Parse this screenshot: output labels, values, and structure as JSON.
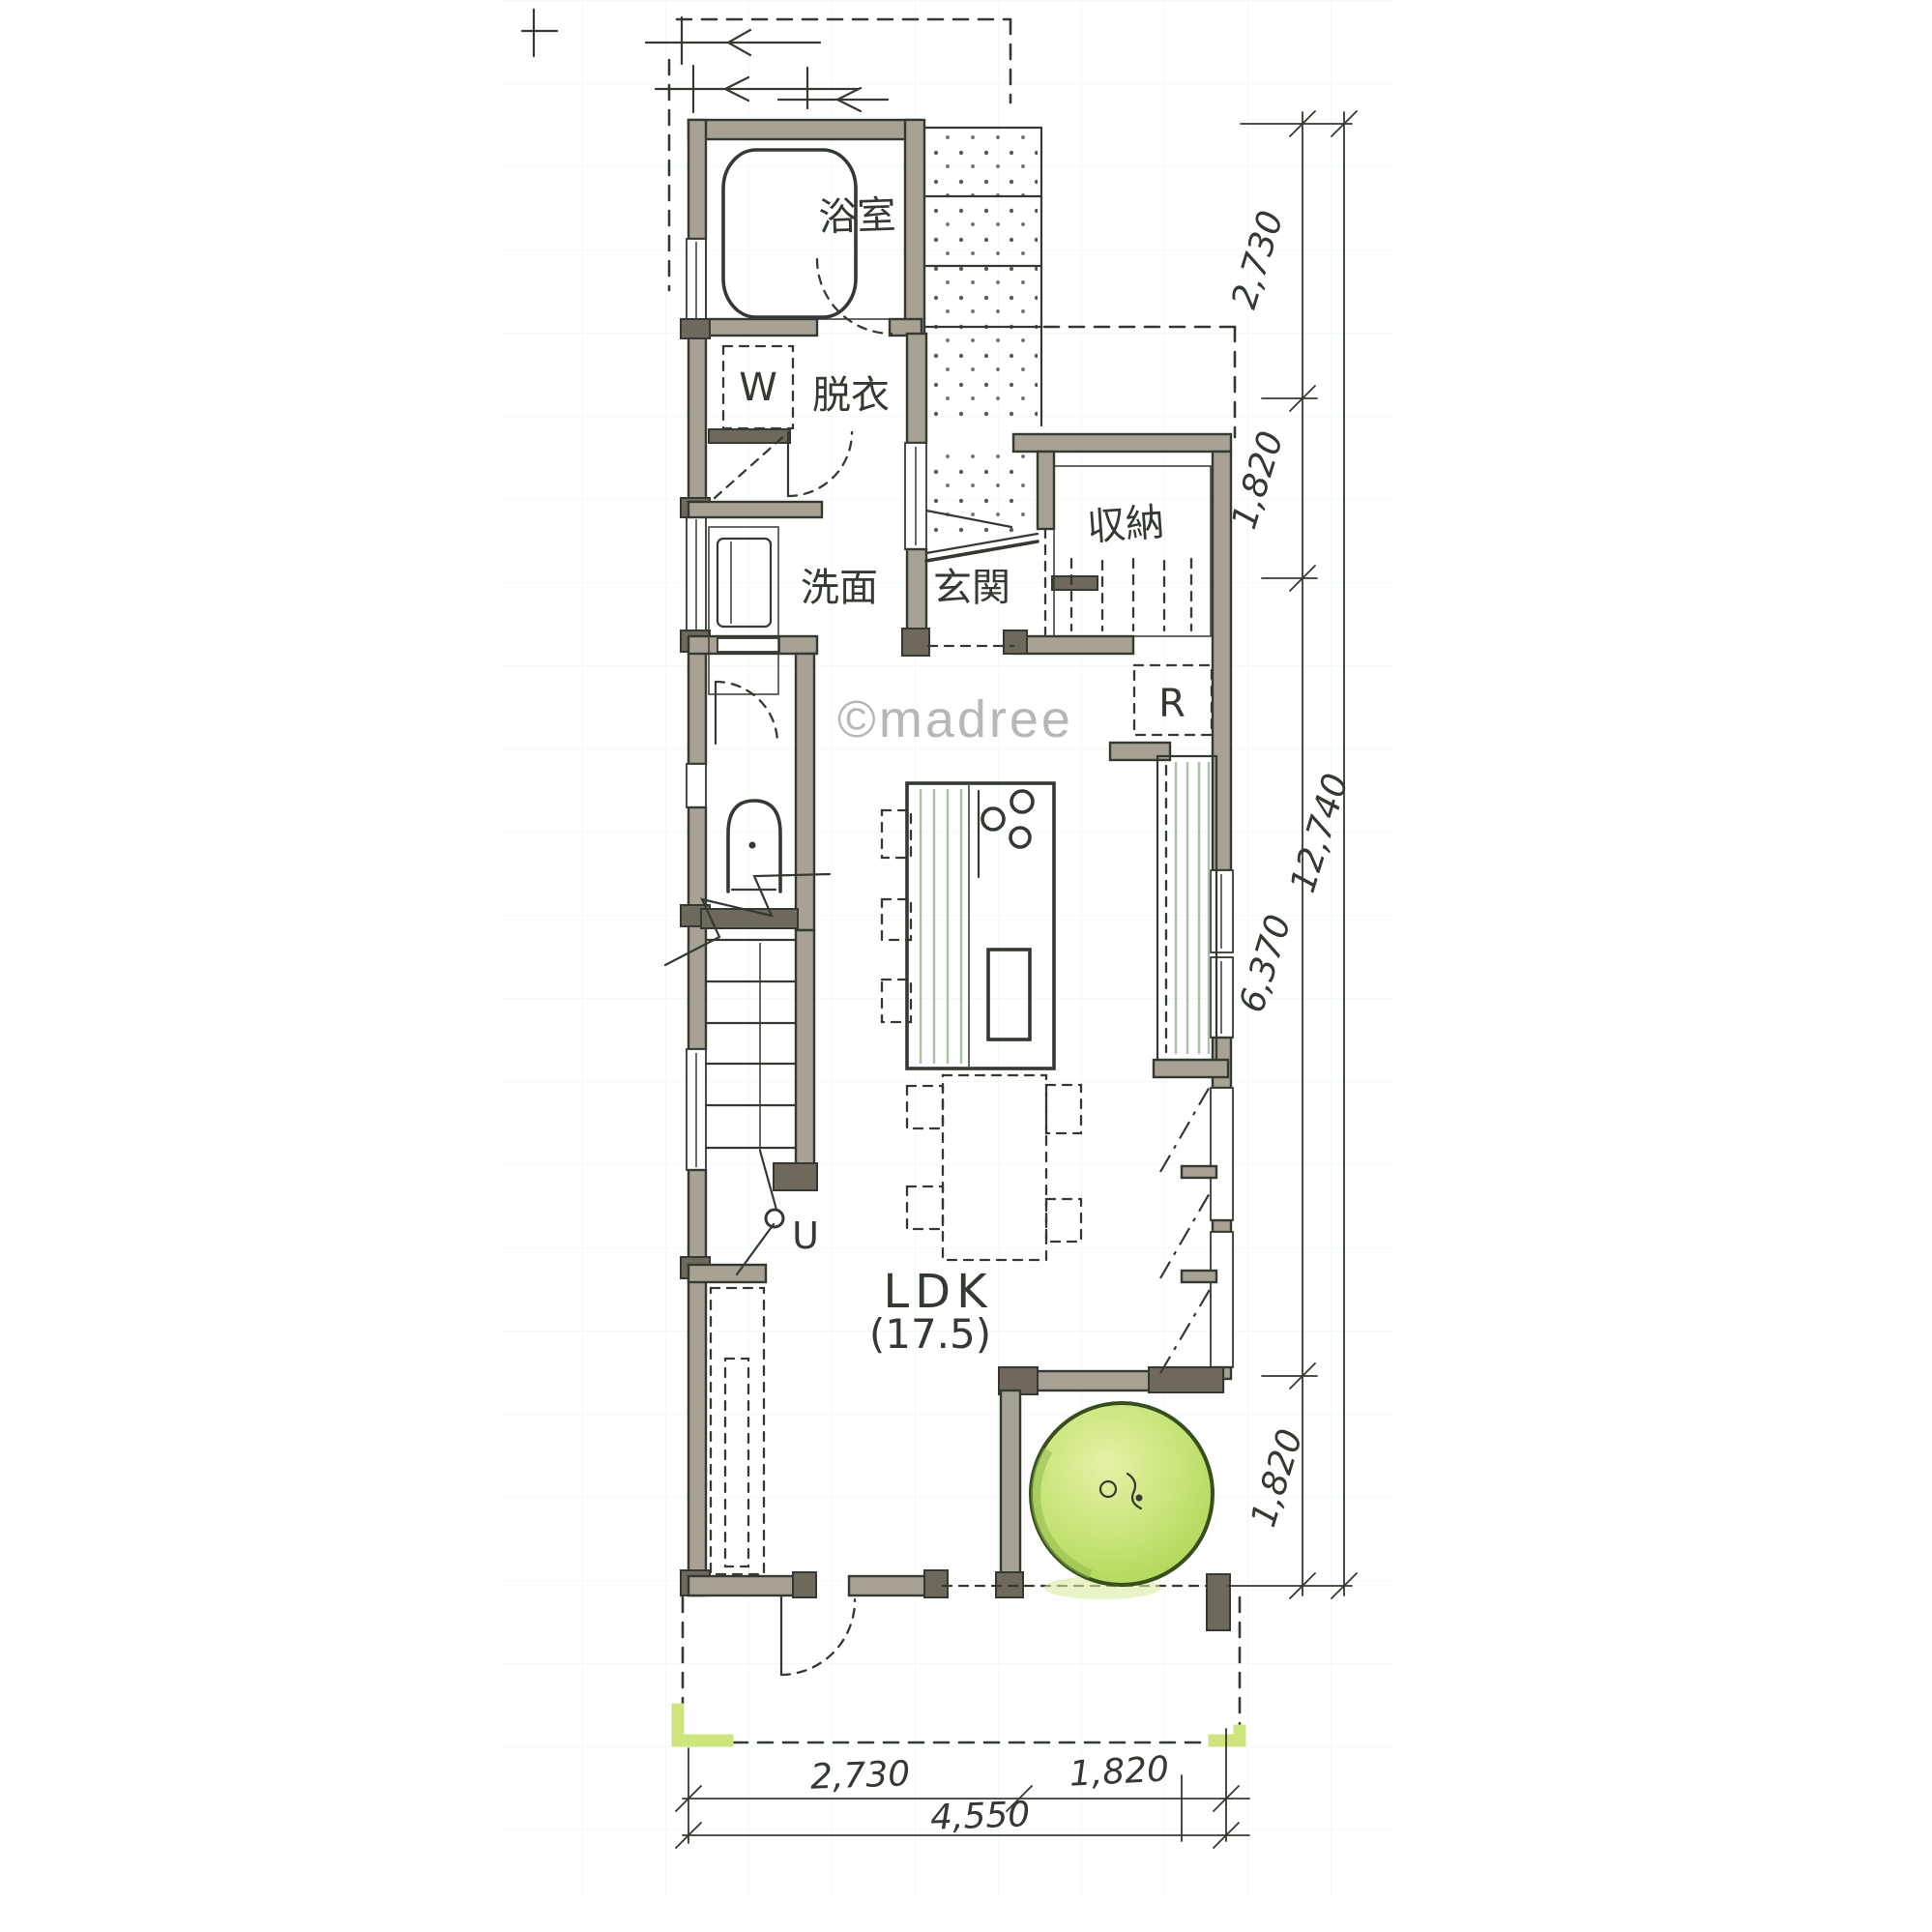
{
  "watermark": "©madree",
  "plan": {
    "rooms": {
      "bathroom": {
        "label": "浴室"
      },
      "dressing": {
        "label": "脱衣"
      },
      "washer": {
        "label": "W"
      },
      "washroom": {
        "label": "洗面"
      },
      "entrance": {
        "label": "玄関"
      },
      "storage": {
        "label": "収納"
      },
      "refrigerator": {
        "label": "R"
      },
      "ldk": {
        "label": "LDK",
        "area": "(17.5)"
      },
      "stairs": {
        "up_label": "U"
      }
    },
    "dimensions": {
      "right_segments": [
        "2,730",
        "1,820",
        "6,370",
        "1,820"
      ],
      "right_total": "12,740",
      "bottom_segments": [
        "2,730",
        "1,820"
      ],
      "bottom_total": "4,550"
    },
    "colors": {
      "wall": "#a8a295",
      "wallDark": "#6e695c",
      "ink": "#343a31",
      "tree": "#c4e173",
      "treeEdge": "#41591f",
      "accent": "#cde67c",
      "watermark": "#b7b7b7",
      "grid": "#79c8b4"
    }
  }
}
